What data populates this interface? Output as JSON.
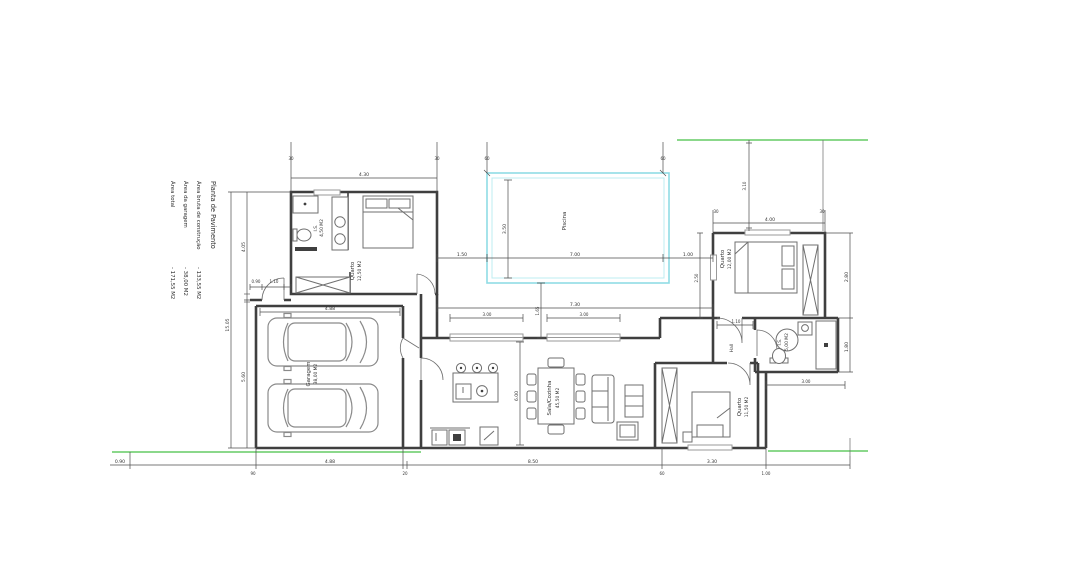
{
  "drawing": {
    "colors": {
      "background": "#ffffff",
      "walls": "#3f3f3f",
      "furniture": "#6f6f6f",
      "dimensions": "#4d4d4d",
      "pool_outline": "#8fdce4",
      "pool_inner": "#bdecf1",
      "boundary_green": "#8bd88b",
      "window": "#9a9a9a",
      "car": "#8a8a8a"
    },
    "title_block": {
      "title": "Planta de Pavimento",
      "items": [
        {
          "label": "Área bruta de construção",
          "value": "- 133,55 M2"
        },
        {
          "label": "Área da garagem",
          "value": "- 38,00 M2"
        },
        {
          "label": "Área total",
          "value": "- 171,55 M2"
        }
      ]
    },
    "rooms": {
      "pool": "Piscina",
      "garage_name": "Garagem",
      "garage_area": "38,00 M2",
      "suite_name": "Quarto",
      "suite_area": "12,50 M2",
      "suite_bath_name": "I.S.",
      "suite_bath_area": "4,50 M2",
      "living_name": "Sala/Cozinha",
      "living_area": "45,50 M2",
      "bedroom2_name": "Quarto",
      "bedroom2_area": "12,00 M2",
      "bedroom3_name": "Quarto",
      "bedroom3_area": "11,50 M2",
      "bath2_name": "I.S.",
      "bath2_area": "5,00 M2",
      "hall_name": "Hall"
    },
    "dims": {
      "suite_top": "4.30",
      "suite_top_l": "30",
      "suite_top_r": "30",
      "pool_ext_l": "60",
      "pool_ext_r": "60",
      "pool_w": "7.00",
      "pool_gap_l": "1.50",
      "pool_gap_r": "1.00",
      "pool_h": "3.50",
      "pool_house": "1.65",
      "left_total": "15.05",
      "left_a": "4.05",
      "left_b": "5.60",
      "entry_a": "0.90",
      "entry_b": "1.10",
      "garage_w": "4.88",
      "terrace_span": "7.30",
      "win_1": "3.00",
      "win_2": "3.00",
      "hall_w": "1.10",
      "living_h": "6.00",
      "bed2_top": "4.00",
      "bed2_top_l": "30",
      "bed2_top_r": "30",
      "bed2_left": "2.50",
      "right_a": "2.80",
      "right_b": "1.80",
      "bath_w": "3.00",
      "setback": "3.10",
      "bottom_0": "0.90",
      "bottom_2": "4.88",
      "bottom_3": "8.50",
      "bottom_4": "3.30",
      "bottom_s1": "90",
      "bottom_s2": "20",
      "bottom_s3": "60",
      "bottom_s4": "1.00"
    }
  }
}
